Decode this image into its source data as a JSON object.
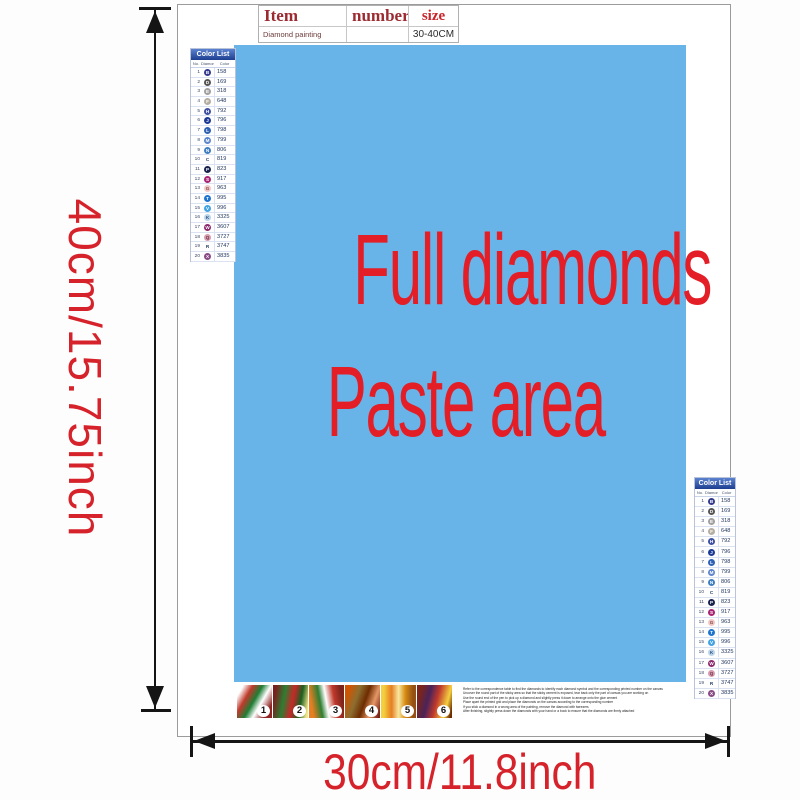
{
  "dimensions": {
    "height_label": "40cm/15.75inch",
    "width_label": "30cm/11.8inch",
    "label_color": "#d6232b"
  },
  "item_table": {
    "col_item": "Item",
    "col_number": "number",
    "col_size": "size",
    "row_item": "Diamond painting",
    "row_number": "",
    "row_size": "30-40CM",
    "header_color": "#9b2b31",
    "size_color": "#c9252b"
  },
  "paste_area": {
    "line1": "Full diamonds",
    "line2": "Paste area",
    "bg_color": "#68b4e8",
    "text_color": "#e41e26"
  },
  "color_list": {
    "title": "Color List",
    "columns": [
      "No.",
      "Diamond",
      "Color"
    ],
    "rows": [
      {
        "no": "1",
        "sym": "B",
        "code": "158",
        "bg": "#343a8c",
        "fg": "#ffffff"
      },
      {
        "no": "2",
        "sym": "D",
        "code": "169",
        "bg": "#555555",
        "fg": "#ffffff"
      },
      {
        "no": "3",
        "sym": "E",
        "code": "318",
        "bg": "#a0a0a0",
        "fg": "#ffffff"
      },
      {
        "no": "4",
        "sym": "F",
        "code": "648",
        "bg": "#b3aea1",
        "fg": "#ffffff"
      },
      {
        "no": "5",
        "sym": "H",
        "code": "792",
        "bg": "#3f51a3",
        "fg": "#ffffff"
      },
      {
        "no": "6",
        "sym": "J",
        "code": "796",
        "bg": "#1c3a96",
        "fg": "#ffffff"
      },
      {
        "no": "7",
        "sym": "L",
        "code": "798",
        "bg": "#2f62b5",
        "fg": "#ffffff"
      },
      {
        "no": "8",
        "sym": "M",
        "code": "799",
        "bg": "#5c85cc",
        "fg": "#ffffff"
      },
      {
        "no": "9",
        "sym": "N",
        "code": "806",
        "bg": "#3f7fc1",
        "fg": "#ffffff"
      },
      {
        "no": "10",
        "sym": "C",
        "code": "819",
        "bg": "transparent",
        "fg": "#223a66"
      },
      {
        "no": "11",
        "sym": "P",
        "code": "823",
        "bg": "#19224f",
        "fg": "#ffffff"
      },
      {
        "no": "12",
        "sym": "S",
        "code": "917",
        "bg": "#a82373",
        "fg": "#ffffff"
      },
      {
        "no": "13",
        "sym": "G",
        "code": "963",
        "bg": "#f3c6c6",
        "fg": "#7a4a4a"
      },
      {
        "no": "14",
        "sym": "T",
        "code": "995",
        "bg": "#1f74cf",
        "fg": "#ffffff"
      },
      {
        "no": "15",
        "sym": "V",
        "code": "996",
        "bg": "#44a3e3",
        "fg": "#ffffff"
      },
      {
        "no": "16",
        "sym": "K",
        "code": "3325",
        "bg": "#b9d3ea",
        "fg": "#33507a"
      },
      {
        "no": "17",
        "sym": "W",
        "code": "3607",
        "bg": "#8e2a6e",
        "fg": "#ffffff"
      },
      {
        "no": "18",
        "sym": "Q",
        "code": "3727",
        "bg": "#d89aae",
        "fg": "#6b3448"
      },
      {
        "no": "19",
        "sym": "R",
        "code": "3747",
        "bg": "transparent",
        "fg": "#223a66"
      },
      {
        "no": "20",
        "sym": "X",
        "code": "3835",
        "bg": "#8a4a86",
        "fg": "#ffffff"
      }
    ]
  },
  "steps": [
    {
      "num": "1",
      "bg": "linear-gradient(120deg,#ffffff 12%,#c0392b 30%,#1e7e34 48%,#ffffff 64%,#8e2424 85%)"
    },
    {
      "num": "2",
      "bg": "linear-gradient(100deg,#7a1f1f 8%,#2e7d32 32%,#c62828 55%,#1b5e20 75%,#f0e68c 95%)"
    },
    {
      "num": "3",
      "bg": "linear-gradient(80deg,#e67e22 12%,#2e7d32 34%,#ffffff 50%,#c0392b 70%,#7b241c 90%)"
    },
    {
      "num": "4",
      "bg": "linear-gradient(110deg,#d35400 10%,#8d6e2f 34%,#6e2c00 55%,#e59866 75%,#7b241c 95%)"
    },
    {
      "num": "5",
      "bg": "linear-gradient(90deg,#f4d03f 8%,#e67e22 30%,#f9e79f 50%,#d68910 70%,#935116 92%)"
    },
    {
      "num": "6",
      "bg": "linear-gradient(105deg,#7b241c 12%,#4a235a 34%,#c0392b 55%,#f4d03f 80%,#6e2c00 95%)"
    }
  ],
  "instructions": [
    "Refer to the correspondence table to find the diamonds to identify each diamond symbol and the corresponding printed number on the canvas",
    "Uncover the round part of the sticky area so that the sticky cement is exposed, tear back only the part of canvas you are working on",
    "Use the round end of the pen to pick up a diamond and slightly press it down to arrange onto the glue cement",
    "Place apart the printed grid and place the diamonds on the canvas according to the corresponding number",
    "If you stick a diamond in a wrong area of the painting, remove the diamond with tweezers",
    "After finishing, slightly press down the diamonds with your hand or a book to ensure that the diamonds are firmly attached"
  ]
}
